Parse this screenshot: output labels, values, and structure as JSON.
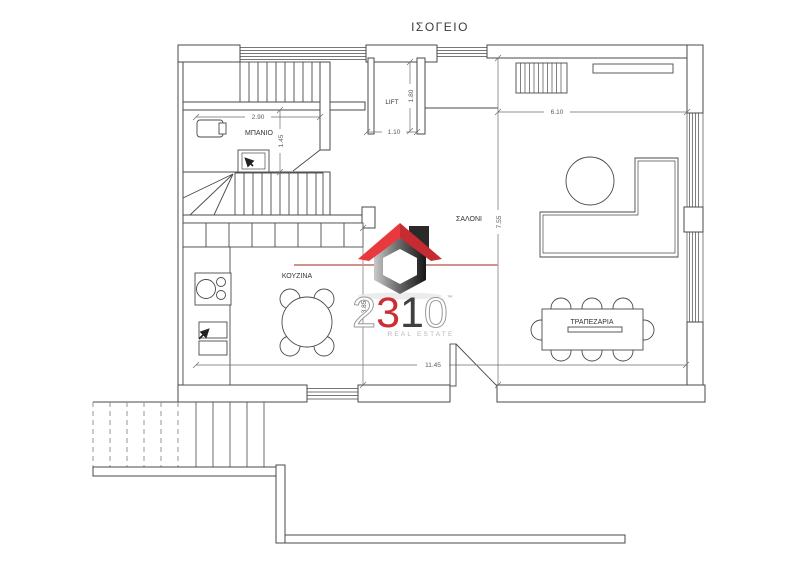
{
  "title": "ΙΣΟΓΕΙΟ",
  "rooms": {
    "bathroom": "ΜΠΑΝΙΟ",
    "lift": "LIFT",
    "living_room": "ΣΑΛΟΝΙ",
    "kitchen": "ΚΟΥΖΙΝΑ",
    "dining_room": "ΤΡΑΠΕΖΑΡΙΑ"
  },
  "dimensions": {
    "bathroom_width": "2.90",
    "bathroom_depth": "1.45",
    "lift_width": "1.10",
    "lift_depth": "1.80",
    "living_width": "6.10",
    "living_depth": "7.55",
    "kitchen_depth": "3.85",
    "overall_width": "11.45"
  },
  "logo": {
    "digits": [
      "2",
      "3",
      "1",
      "0"
    ],
    "trademark": "™",
    "subtitle": "REAL ESTATE"
  },
  "colors": {
    "plan_line": "#4a4a4a",
    "dimension_line": "#6e6e6e",
    "label_text": "#333333",
    "watermark_line": "#d1918d",
    "logo_red_light": "#e8393f",
    "logo_red_dark": "#c62b31",
    "logo_red_digit": "#cb2f35",
    "logo_gray": "#9a9a9a"
  }
}
